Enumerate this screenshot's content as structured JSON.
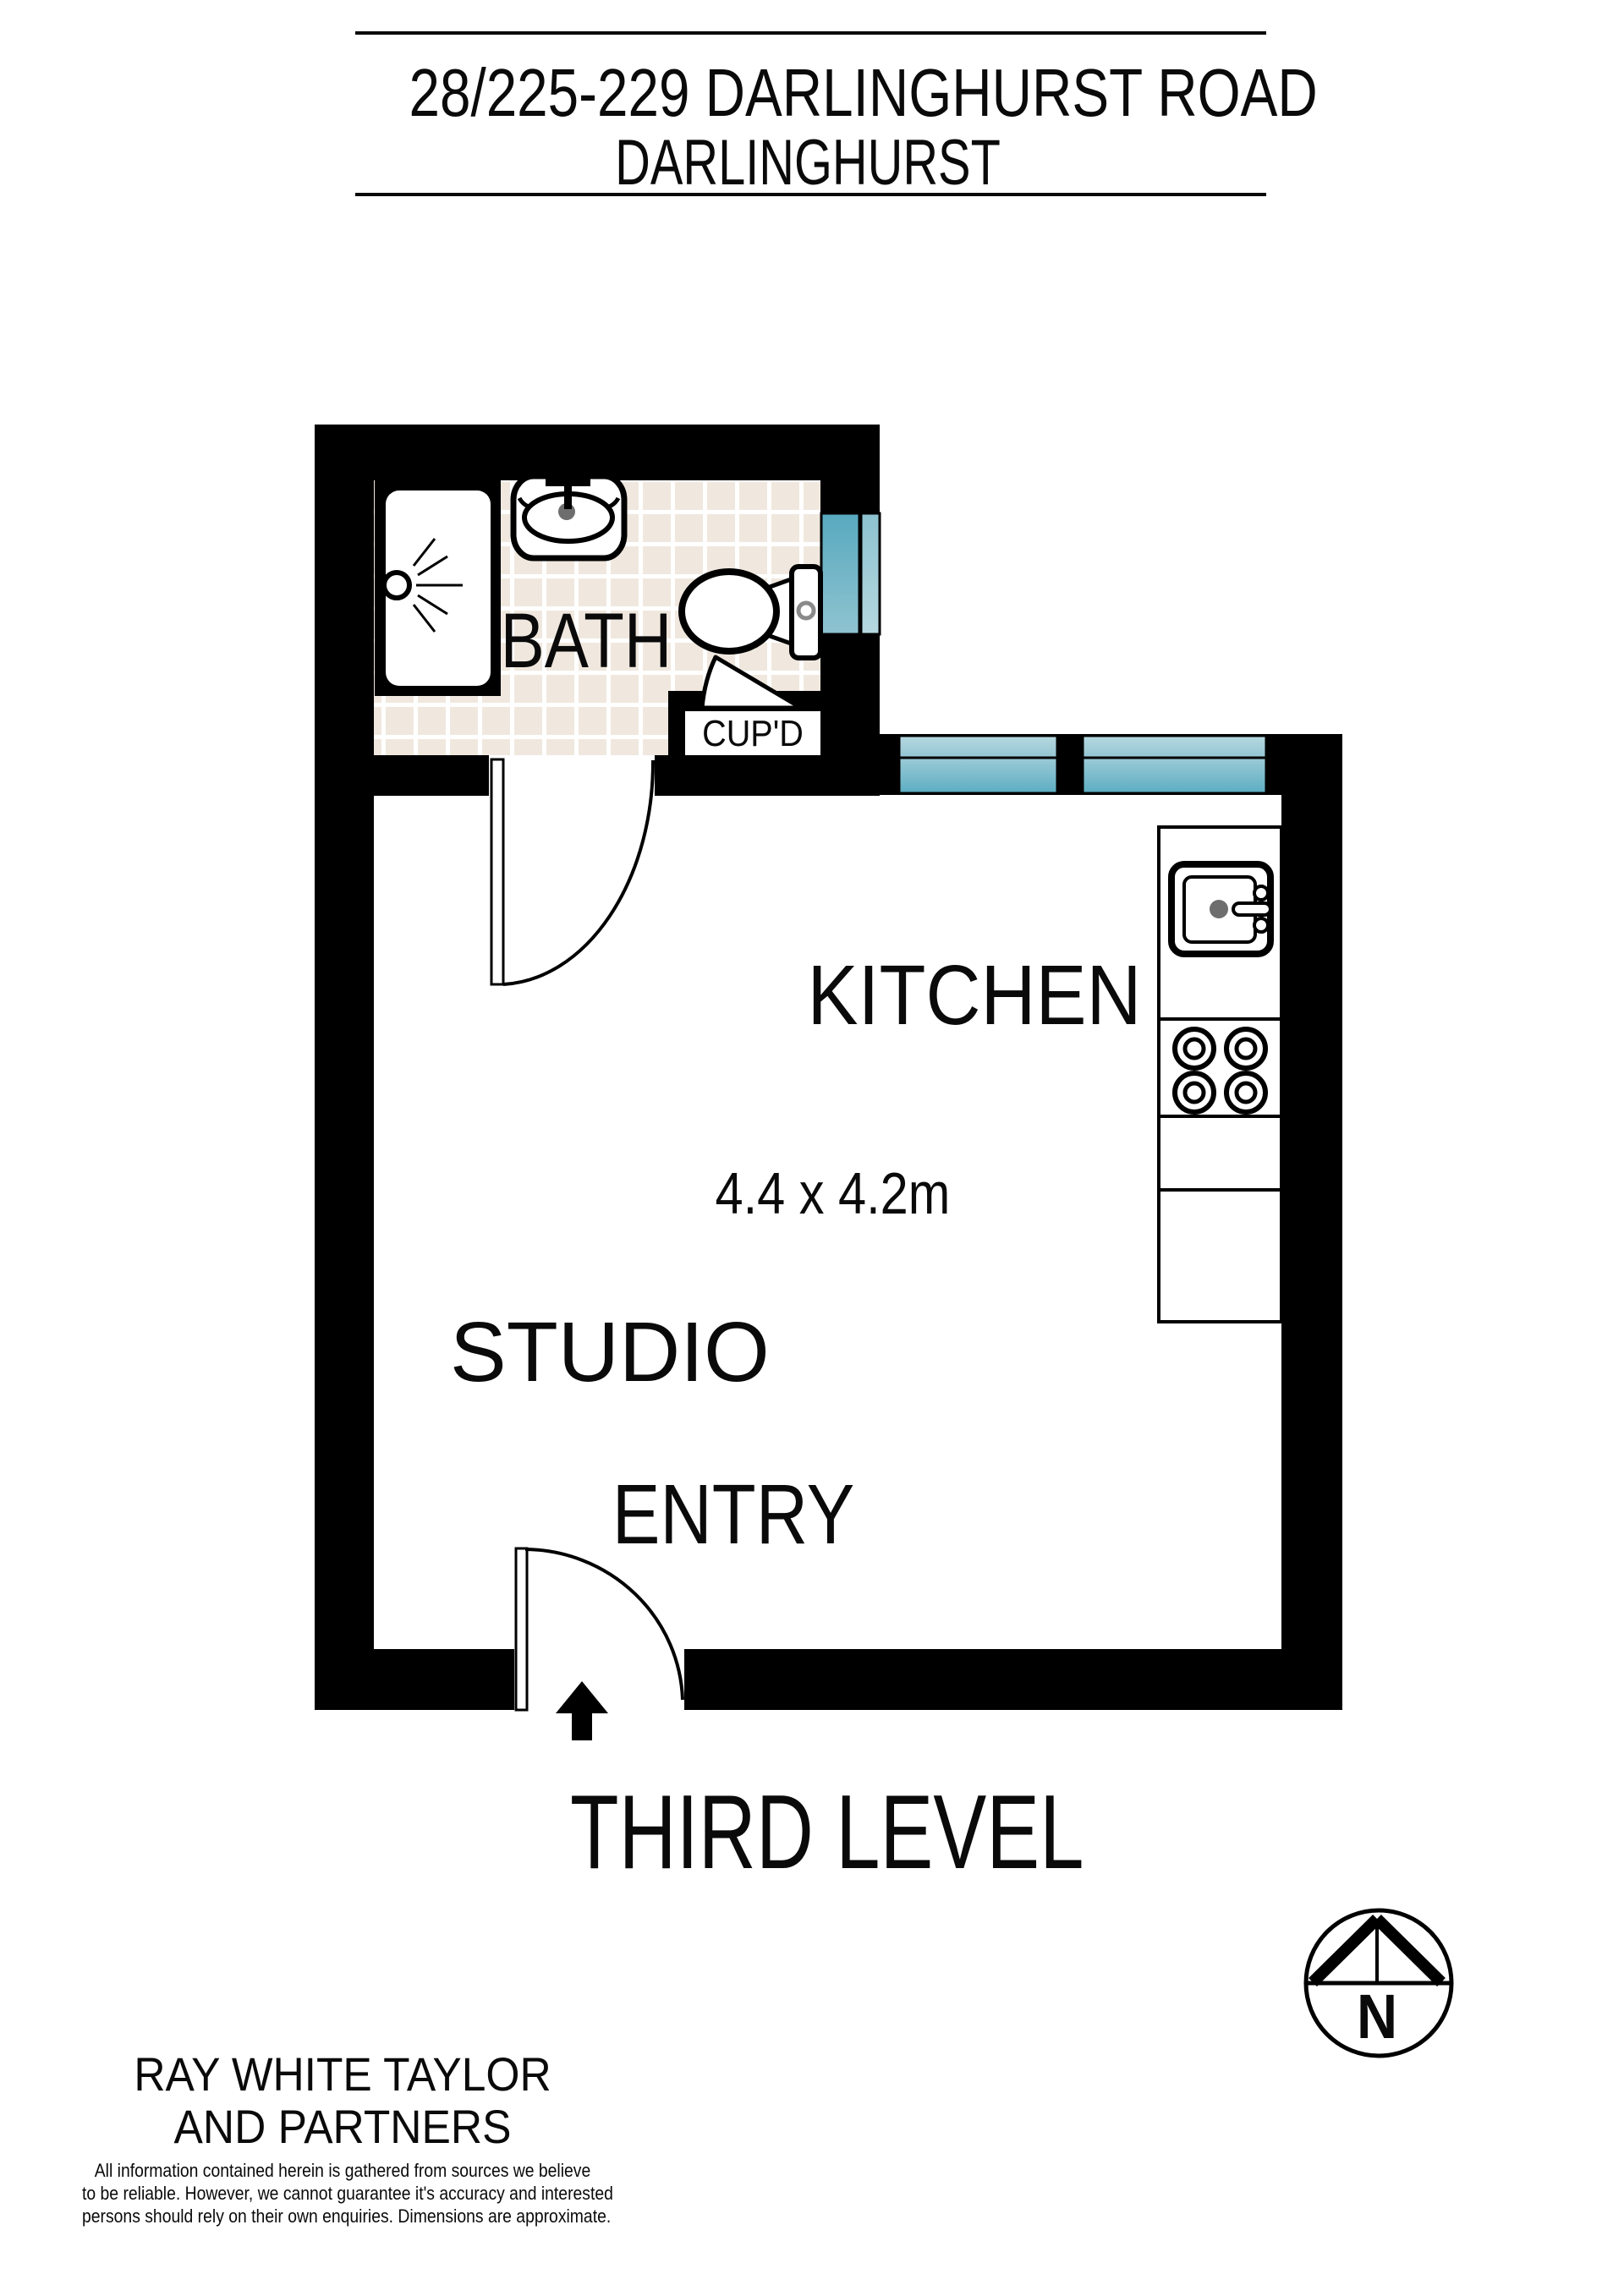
{
  "header": {
    "address_line1": "28/225-229 DARLINGHURST ROAD",
    "address_line2": "DARLINGHURST"
  },
  "floor_plan": {
    "rooms": {
      "bath": "BATH",
      "cupboard": "CUP'D",
      "kitchen": "KITCHEN",
      "studio": "STUDIO",
      "entry": "ENTRY"
    },
    "studio_dimensions": "4.4 x 4.2m",
    "level_label": "THIRD LEVEL",
    "compass_north": "N"
  },
  "footer": {
    "agency_name_line1": "RAY WHITE TAYLOR",
    "agency_name_line2": "AND PARTNERS",
    "disclaimer_line1": "All information contained herein is gathered from sources we believe",
    "disclaimer_line2": "to be reliable. However, we cannot guarantee it's accuracy and interested",
    "disclaimer_line3": "persons should rely on their own enquiries. Dimensions are approximate."
  },
  "colors": {
    "wall": "#000000",
    "window_teal": "#5FB0C5",
    "window_teal_light": "#A9CFD9",
    "tile_beige": "#F0E8DE",
    "fixture_gray": "#6E6E6E"
  }
}
